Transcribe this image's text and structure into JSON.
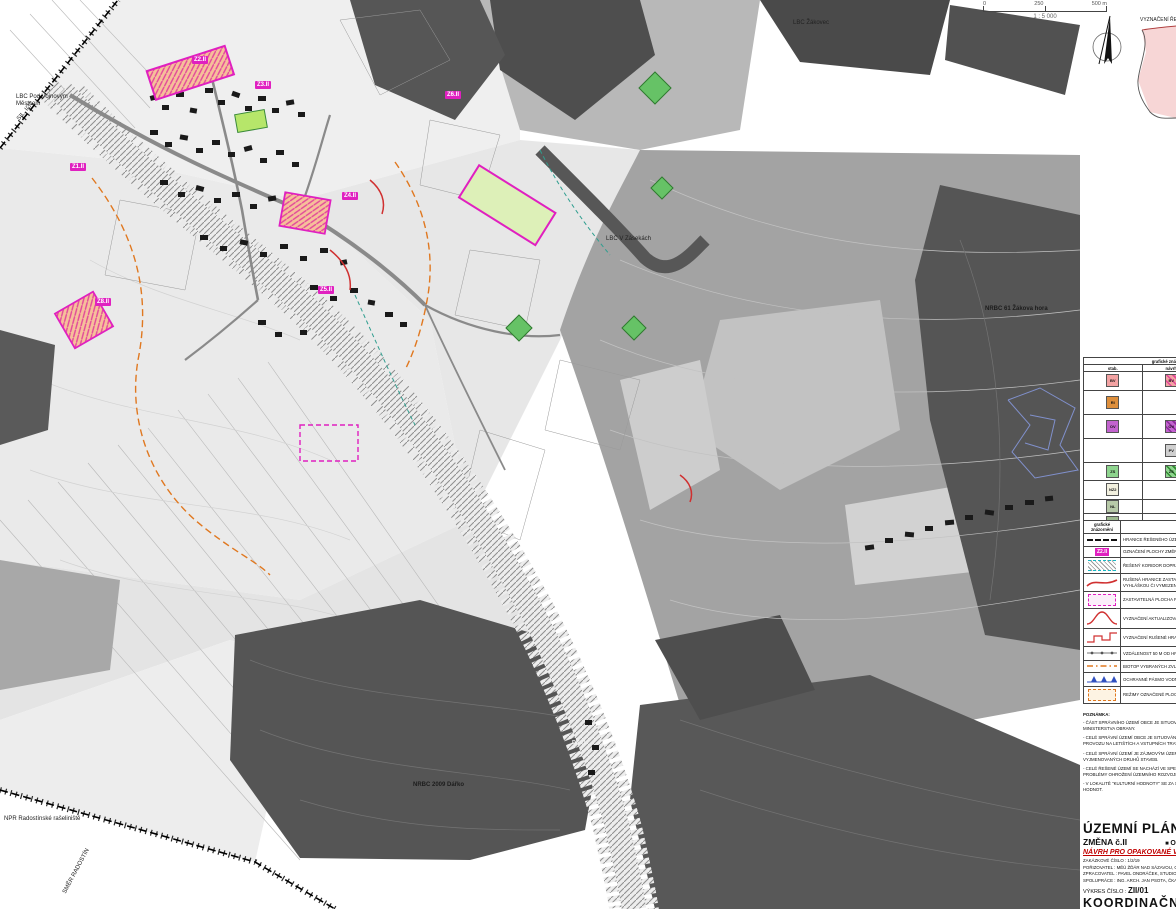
{
  "map": {
    "labels": {
      "lbc_pod": "LBC Pod Vojnovým Městcem",
      "lbc_zaseky": "LBC V Zásekách",
      "lbc_zakovec": "LBC Žákovec",
      "nrbc_zakova": "NRBC 61 Žákova hora",
      "nrbc_darko": "NRBC 2009 Dářko",
      "npr": "NPR Radostínské rašeliniště",
      "smer": "SMĚR RADOSTÍN",
      "sil": "SIL. I/37",
      "corridor": "DK01"
    },
    "zones": {
      "z1": "Z1.II",
      "z2": "Z2.II",
      "z3": "Z3.II",
      "z4": "Z4.II",
      "z5": "Z5.II",
      "z6": "Z6.II",
      "z7": "Z8.II"
    },
    "inset_label": "VYZNAČENÍ ŘEŠENÉHO ÚZEMÍ",
    "accent_magenta": "#e020c0",
    "accent_cyan": "#17b8c4",
    "accent_orange": "#e07820"
  },
  "scale": {
    "t0": "0",
    "t1": "250",
    "t2": "500 m",
    "ratio": "1 : 5 000"
  },
  "legend_use": {
    "h_graf": "grafické znázornění",
    "h_stab": "stab.",
    "h_navrh": "návrh",
    "h_rezerv": "rezerv.",
    "h_desc": "PLOCHY S ROZDÍLNÝM ZPŮSOBEM VYUŽITÍ",
    "rows": [
      {
        "l1": "BV",
        "b1": "#f2a2a2",
        "l2": "BV",
        "b2": "repeating-linear-gradient(45deg,#f2a2a2 0 3px,#e2489a 3px 4.5px)",
        "l3": "",
        "b3": "transparent",
        "t1": "PLOCHY BYDLENÍ",
        "t2": "- BYDLENÍ V RODINNÝCH DOMECH (BV)"
      },
      {
        "l1": "RI",
        "b1": "#de8f3c",
        "l2": "",
        "b2": "transparent",
        "l3": "",
        "b3": "transparent",
        "t1": "PLOCHY REKREACE",
        "t2": "- PLOCHY STAVEB PRO RODINNOU REKREACI (RI)"
      },
      {
        "l1": "OV",
        "b1": "#c263ce",
        "l2": "OV",
        "b2": "repeating-linear-gradient(45deg,#c263ce 0 3px,#8a2a9a 3px 4.5px)",
        "l3": "",
        "b3": "transparent",
        "t1": "PLOCHY OBČANSKÉHO VYBAVENÍ",
        "t2": "- VEŘEJNÁ INFRASTRUKTURA (OV)"
      },
      {
        "l1": "",
        "b1": "transparent",
        "l2": "PV",
        "b2": "#cfcfcf",
        "l3": "",
        "b3": "transparent",
        "t1": "PLOCHY VEŘEJNÝCH PROSTRANSTVÍ",
        "t2": "- VEŘEJNÁ PROSTRANSTVÍ (PV)"
      },
      {
        "l1": "ZS",
        "b1": "#8ed48e",
        "l2": "ZS",
        "b2": "repeating-linear-gradient(45deg,#8ed48e 0 3px,#2f8a2f 3px 4.5px)",
        "l3": "",
        "b3": "transparent",
        "t1": "PLOCHY ZELENĚ",
        "t2": "- SOUKROMÁ A VYHRAZENÁ (ZS)"
      },
      {
        "l1": "NZ2",
        "b1": "#f2f0df",
        "l2": "",
        "b2": "transparent",
        "l3": "",
        "b3": "transparent",
        "t1": "PLOCHY ZEMĚDĚLSKÉ",
        "t2": "- TRVALÉ TRAVNÍ POROSTY (NZ2)"
      },
      {
        "l1": "NL",
        "b1": "#b7c9a8",
        "l2": "",
        "b2": "transparent",
        "l3": "",
        "b3": "transparent",
        "t1": "PLOCHY LESNÍ (NL)",
        "t2": ""
      },
      {
        "l1": "NSp",
        "b1": "#9db98f",
        "l2": "",
        "b2": "transparent",
        "l3": "",
        "b3": "transparent",
        "t1": "PLOCHY SMÍŠENÉ NEZASTAVĚNÉHO ÚZEMÍ (NS)",
        "t2": ""
      }
    ]
  },
  "legend_symbols": {
    "h_graf": "grafické znázornění",
    "h_desc": "popis",
    "tag_label": "Z2.II",
    "rows": [
      {
        "t": "HRANICE ŘEŠENÉHO ÚZEMÍ"
      },
      {
        "t": "OZNAČENÍ PLOCHY ZMĚNY Č.II S OZNAČENÍM - ZASTAVITELNÁ PLOCHA"
      },
      {
        "t": "ŘEŠENÝ KORIDOR DOPRAVNÍ INFRASTRUKTURY"
      },
      {
        "t": "RUŠENÁ HRANICE ZASTAVITELNÉ PLOCHY, KDY NOVÁ HRANICE ŘEŠENA VEŘEJNOU VYHLÁŠKOU ČI VYMEZENÍM NOVÉ PLOCHY SE ZMĚNOU Č.II"
      },
      {
        "t": "ZASTAVITELNÁ PLOCHA PLATNÉHO ÚP UPRAVENÁ"
      },
      {
        "t": "VYZNAČENÍ AKTUALIZOVANÉHO ZASTAVĚNÉHO ÚZEMÍ K 08.05.2024"
      },
      {
        "t": "VYZNAČENÍ RUŠENÉ HRANICE ZASTAVĚNÉHO ÚZEMÍ V PLATNÉM ÚP (K DATU 05.08.2023)"
      },
      {
        "t": "VZDÁLENOST 50 M OD HRANICE LESA - POZEMKŮ URČENÝCH K PLNĚNÍ FUNKCÍ LESA"
      },
      {
        "t": "BIOTOP VYBRANÝCH ZVLÁŠŤ CHRÁNĚNÝCH DRUHŮ VELKÝCH SAVCŮ"
      },
      {
        "t": "OCHRANNÉ PÁSMO VODNÍHO ZDROJE I. A II. STUPNĚ"
      },
      {
        "t": "REŽIMY OZNAČENÉ PLOCHY SE STANOVENOU ÚZEMNÍ STUDIÍ (ÚS)"
      }
    ]
  },
  "notes": {
    "title": "POZNÁMKA:",
    "items": [
      "- ČÁST SPRÁVNÍHO ÚZEMÍ OBCE JE SITUOVÁNA V OCHRANNÉM PÁSMU RADIOLOKAČNÍHO ZAŘÍZENÍ MINISTERSTVA OBRANY.",
      "- CELÉ SPRÁVNÍ ÚZEMÍ OBCE JE SITUOVÁNO VE VZDUŠNÉM PROSTORU K OCHRANĚ LETOVÉHO PROVOZU NA LETIŠTÍCH A VSTUPNÍCH TRATÍCH MINISTERSTVA OBRANY.",
      "- CELÉ SPRÁVNÍ ÚZEMÍ JE ZÁJMOVÝM ÚZEMÍM MINISTERSTVA OBRANY Z HLEDISKA POVOLOVÁNÍ VYJMENOVANÝCH DRUHŮ STAVEB.",
      "- CELÉ ŘEŠENÉ ÚZEMÍ SE NACHÁZÍ VE SPECIFICKÉ OBLASTI, KTERÁ SE PROJEVUJE AKTUÁLNÍMI PROBLÉMY OHROŽENÍ ÚZEMNÍHO ROZVOJE ČR.",
      "- V LOKALITĚ \"KULTURNÍ HODNOTY\" SE ZA STÁVAJÍCÍ TAKÉ POVAŽUJÍ VÝŠKOVÉ HRANICE VEŘEJNÝCH HODNOT."
    ]
  },
  "titleblock": {
    "title": "ÚZEMNÍ PLÁN VOJNŮV MĚSTEC",
    "change": "ZMĚNA č.II",
    "bullet": "O",
    "red_line": "NÁVRH PRO OPAKOVANÉ VEŘEJNÉ PROJEDNÁNÍ",
    "meta1": "ZAKÁZKOVÉ ČÍSLO : 1/2/19",
    "meta2": "POŘIZOVATEL : MĚÚ ŽĎÁR NAD SÁZAVOU, ODBOR STAVEBNÍ",
    "meta3": "ZPRACOVATEL : PAVEL ONDRÁČEK, STUDIO-P, NÁDRAŽNÍ 52",
    "meta4": "SPOLUPRÁCE : ING. ARCH. JAN PSOTA, ČKA 1042",
    "drawno_label": "VÝKRES ČÍSLO :",
    "drawno": "ZII/01",
    "drawing": "KOORDINAČNÍ VÝKRES"
  }
}
